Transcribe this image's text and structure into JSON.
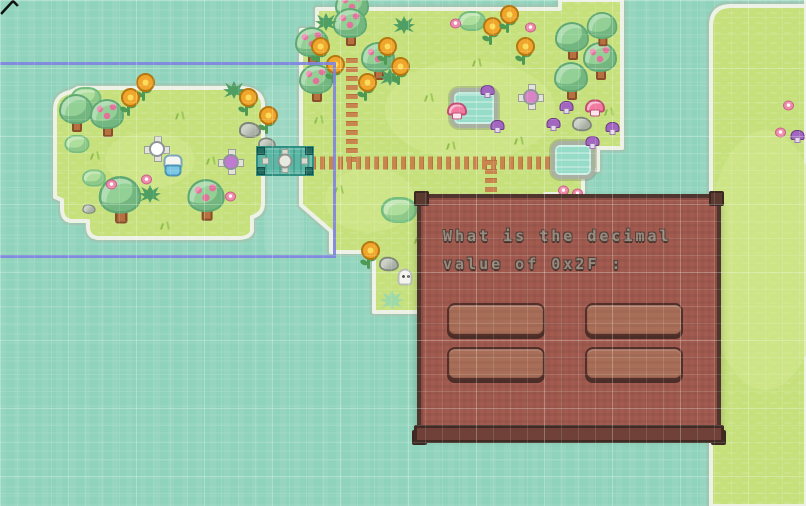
{
  "dialog": {
    "question_line1": "What is the decimal",
    "question_line2": "value of 0x2F :",
    "answers": [
      {
        "label": ""
      },
      {
        "label": ""
      },
      {
        "label": ""
      },
      {
        "label": ""
      }
    ]
  },
  "colors": {
    "water": "#90d3bc",
    "grass": "#c6e07c",
    "island_edge": "#eef2e6",
    "dialog_bg": "#a35b50",
    "dialog_border": "#50352e",
    "button_bg": "#a96e58",
    "overlay_purple": "#8084de",
    "path_brown": "#c9854e",
    "bridge_teal": "#5ab7a6"
  },
  "terrain": {
    "left_island": "M 78 88 L 243 88 Q 262 90 263 104 L 263 147 L 270 150 L 270 170 L 263 173 L 263 203 Q 263 214 252 217 L 252 231 Q 250 238 238 238 L 98 238 Q 88 237 88 227 L 88 221 L 71 221 Q 62 220 62 208 L 62 200 L 55 197 L 55 110 Q 55 95 70 92 Z",
    "main_island": "M 301 205 L 301 30 L 317 30 L 317 9 L 560 9 L 560 0 L 622 0 L 622 148 L 598 148 L 598 170 L 583 170 L 583 191 Q 583 199 573 199 L 563 199 L 563 194 L 545 194 L 545 232 L 422 232 L 422 252 L 422 312 L 374 312 L 374 252 L 331 252 L 331 231 Z",
    "right_strip": "M 806 0 L 806 506 L 711 506 L 711 26 Q 711 6 731 6 L 806 6 Z"
  },
  "decorations": [
    {
      "t": "pathv",
      "x": 352,
      "y": 108,
      "w": 12,
      "h": 108
    },
    {
      "t": "pathh",
      "x": 445,
      "y": 163,
      "w": 268,
      "h": 13
    },
    {
      "t": "pathv",
      "x": 491,
      "y": 180,
      "w": 12,
      "h": 42
    },
    {
      "t": "pond",
      "x": 474,
      "y": 108,
      "w": 40,
      "h": 32
    },
    {
      "t": "pond",
      "x": 573,
      "y": 160,
      "w": 36,
      "h": 30
    },
    {
      "t": "bush",
      "x": 86,
      "y": 98,
      "s": 1.1
    },
    {
      "t": "tree",
      "x": 76,
      "y": 114
    },
    {
      "t": "apple",
      "x": 107,
      "y": 119
    },
    {
      "t": "bush",
      "x": 77,
      "y": 144,
      "s": 0.9
    },
    {
      "t": "bush",
      "x": 94,
      "y": 178,
      "s": 0.85
    },
    {
      "t": "tree",
      "x": 120,
      "y": 201,
      "s": 1.25
    },
    {
      "t": "apple",
      "x": 206,
      "y": 201,
      "s": 1.1
    },
    {
      "t": "fern",
      "x": 234,
      "y": 90
    },
    {
      "t": "fern",
      "x": 150,
      "y": 194
    },
    {
      "t": "sunflower",
      "x": 143,
      "y": 88
    },
    {
      "t": "sunflower",
      "x": 128,
      "y": 103
    },
    {
      "t": "sunflower",
      "x": 246,
      "y": 103
    },
    {
      "t": "sunflower",
      "x": 266,
      "y": 121
    },
    {
      "t": "rock",
      "x": 250,
      "y": 130
    },
    {
      "t": "rock",
      "x": 267,
      "y": 144,
      "s": 0.8
    },
    {
      "t": "rock",
      "x": 89,
      "y": 209,
      "s": 0.6
    },
    {
      "t": "grass",
      "x": 181,
      "y": 116
    },
    {
      "t": "grass",
      "x": 96,
      "y": 156
    },
    {
      "t": "grass",
      "x": 212,
      "y": 161
    },
    {
      "t": "grass",
      "x": 166,
      "y": 226
    },
    {
      "t": "flowerp",
      "x": 146,
      "y": 179
    },
    {
      "t": "flowerp",
      "x": 230,
      "y": 196
    },
    {
      "t": "flowerp",
      "x": 111,
      "y": 184
    },
    {
      "t": "pin",
      "x": 157,
      "y": 149,
      "c": "#ffffff"
    },
    {
      "t": "pin",
      "x": 231,
      "y": 162,
      "c": "#c07ad0"
    },
    {
      "t": "creature",
      "x": 172,
      "y": 165
    },
    {
      "t": "apple",
      "x": 352,
      "y": 10
    },
    {
      "t": "apple",
      "x": 312,
      "y": 47
    },
    {
      "t": "apple",
      "x": 350,
      "y": 28
    },
    {
      "t": "apple",
      "x": 378,
      "y": 62
    },
    {
      "t": "apple",
      "x": 316,
      "y": 84
    },
    {
      "t": "fern",
      "x": 404,
      "y": 25
    },
    {
      "t": "fern",
      "x": 390,
      "y": 77
    },
    {
      "t": "fern",
      "x": 326,
      "y": 22
    },
    {
      "t": "sunflower",
      "x": 318,
      "y": 52
    },
    {
      "t": "sunflower",
      "x": 385,
      "y": 52
    },
    {
      "t": "sunflower",
      "x": 333,
      "y": 70
    },
    {
      "t": "sunflower",
      "x": 398,
      "y": 72
    },
    {
      "t": "sunflower",
      "x": 365,
      "y": 88
    },
    {
      "t": "bush",
      "x": 472,
      "y": 21
    },
    {
      "t": "flowerp",
      "x": 455,
      "y": 23
    },
    {
      "t": "flowerp",
      "x": 530,
      "y": 27
    },
    {
      "t": "sunflower",
      "x": 490,
      "y": 32
    },
    {
      "t": "sunflower",
      "x": 507,
      "y": 20
    },
    {
      "t": "sunflower",
      "x": 523,
      "y": 52
    },
    {
      "t": "tree",
      "x": 572,
      "y": 42
    },
    {
      "t": "apple",
      "x": 600,
      "y": 62
    },
    {
      "t": "tree",
      "x": 571,
      "y": 82
    },
    {
      "t": "tree",
      "x": 602,
      "y": 30,
      "s": 0.9
    },
    {
      "t": "mush",
      "x": 487,
      "y": 91
    },
    {
      "t": "mush",
      "x": 497,
      "y": 126
    },
    {
      "t": "mush",
      "x": 553,
      "y": 124
    },
    {
      "t": "mush",
      "x": 566,
      "y": 107
    },
    {
      "t": "mush",
      "x": 612,
      "y": 128
    },
    {
      "t": "mush",
      "x": 592,
      "y": 142
    },
    {
      "t": "mushp",
      "x": 456,
      "y": 111
    },
    {
      "t": "mushp",
      "x": 594,
      "y": 108
    },
    {
      "t": "pin",
      "x": 531,
      "y": 97,
      "c": "#d985c5"
    },
    {
      "t": "rock",
      "x": 582,
      "y": 124,
      "s": 0.9
    },
    {
      "t": "grass",
      "x": 430,
      "y": 98
    },
    {
      "t": "grass",
      "x": 452,
      "y": 146
    },
    {
      "t": "grass",
      "x": 478,
      "y": 63
    },
    {
      "t": "grass",
      "x": 520,
      "y": 141
    },
    {
      "t": "grass",
      "x": 610,
      "y": 112
    },
    {
      "t": "grass",
      "x": 340,
      "y": 190
    },
    {
      "t": "grass",
      "x": 320,
      "y": 120
    },
    {
      "t": "flowerp",
      "x": 563,
      "y": 190
    },
    {
      "t": "flowerp",
      "x": 577,
      "y": 193
    },
    {
      "t": "bush",
      "x": 399,
      "y": 210,
      "s": 1.3
    },
    {
      "t": "sunflower",
      "x": 368,
      "y": 256
    },
    {
      "t": "rock",
      "x": 389,
      "y": 264,
      "s": 0.9
    },
    {
      "t": "ghost",
      "x": 405,
      "y": 277
    },
    {
      "t": "clover",
      "x": 392,
      "y": 300
    },
    {
      "t": "grass",
      "x": 420,
      "y": 240
    },
    {
      "t": "flowerp",
      "x": 788,
      "y": 105
    },
    {
      "t": "flowerp",
      "x": 780,
      "y": 132
    },
    {
      "t": "mush",
      "x": 797,
      "y": 136
    },
    {
      "t": "bridge",
      "x": 285,
      "y": 161,
      "w": 54,
      "h": 26
    }
  ]
}
